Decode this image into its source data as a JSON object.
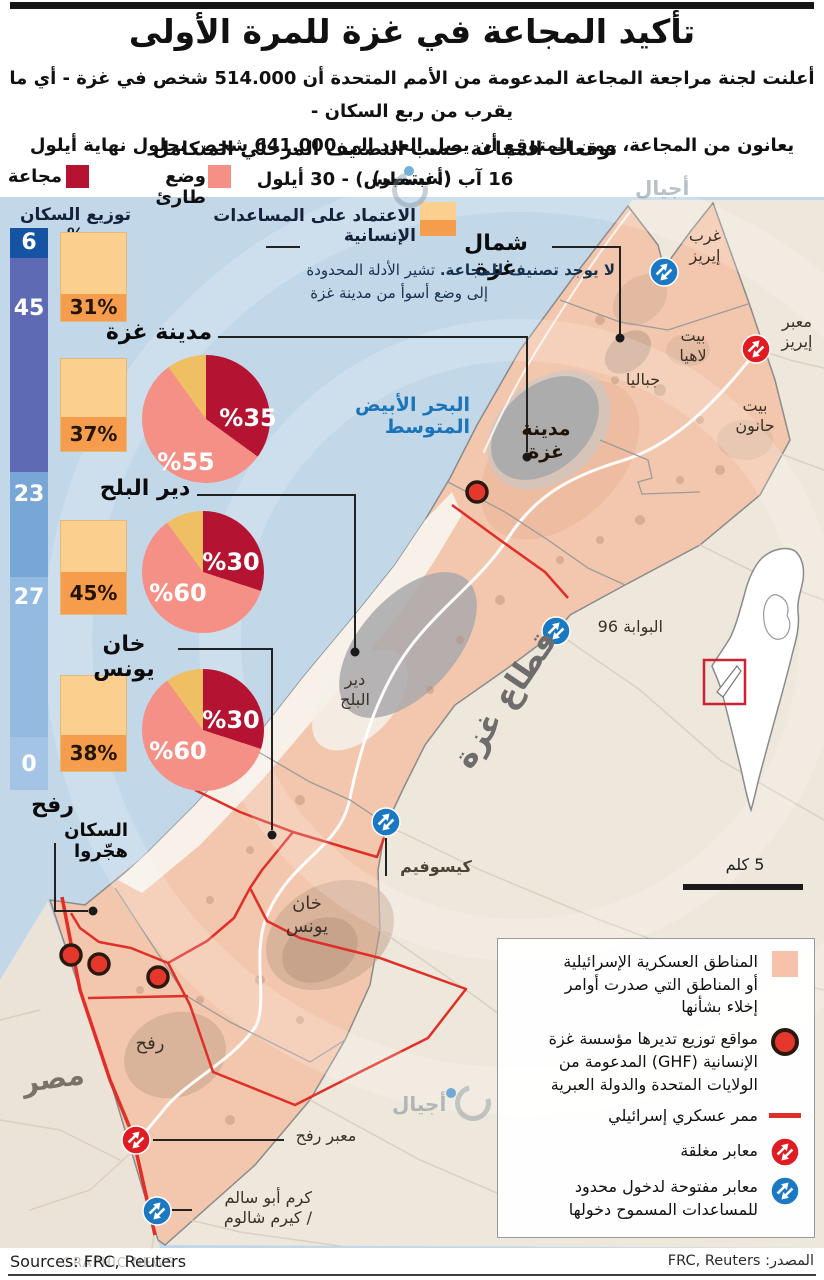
{
  "header": {
    "title": "تأكيد المجاعة في غزة للمرة الأولى",
    "intro_line1": "أعلنت لجنة مراجعة المجاعة المدعومة من الأمم المتحدة أن 514.000 شخص في غزة - أي ما يقرب من ربع السكان -",
    "intro_line2": "يعانون من المجاعة، ومن المتوقع أن يصل العدد إلى 641.000 شخص بحلول نهاية أيلول (سبتمبر)",
    "subtitle": "توقعات المجاعة حسب التصنيف المرحلي المتكامل",
    "date_range": "16 آب (أغسطس) - 30 أيلول"
  },
  "ipc_legend": {
    "famine_label": "مجاعة",
    "emergency_label": "وضع طارئ"
  },
  "panel": {
    "population_header": "توزيع السكان %",
    "aid_header": "الاعتماد على المساعدات الإنسانية"
  },
  "population_bar": [
    "6",
    "45",
    "23",
    "27",
    "0"
  ],
  "regions": [
    {
      "name": "شمال غزة",
      "aid_label": "31%",
      "note_bold": "لا يوجد تصنيف للمجاعة.",
      "note_rest": " تشير الأدلة المحدودة",
      "note_line2": "إلى وضع أسوأ من مدينة غزة"
    },
    {
      "name": "مدينة غزة",
      "aid_label": "37%",
      "famine_label": "%35",
      "emergency_label": "%55"
    },
    {
      "name": "دير البلح",
      "aid_label": "45%",
      "famine_label": "%30",
      "emergency_label": "%60"
    },
    {
      "name": "خان يونس",
      "aid_label": "38%",
      "famine_label": "%30",
      "emergency_label": "%60"
    },
    {
      "name": "رفح",
      "displaced_note": "السكان هجّروا"
    }
  ],
  "chart_data": {
    "type": "pie",
    "title": "توقعات المجاعة حسب التصنيف المرحلي المتكامل، 16 آب - 30 أيلول",
    "legend": [
      "مجاعة",
      "وضع طارئ"
    ],
    "series": [
      {
        "region": "شمال غزة",
        "famine_pct": null,
        "emergency_pct": null,
        "aid_dependence_pct": 31,
        "population_share_pct": 6
      },
      {
        "region": "مدينة غزة",
        "famine_pct": 35,
        "emergency_pct": 55,
        "aid_dependence_pct": 37,
        "population_share_pct": 45
      },
      {
        "region": "دير البلح",
        "famine_pct": 30,
        "emergency_pct": 60,
        "aid_dependence_pct": 45,
        "population_share_pct": 23
      },
      {
        "region": "خان يونس",
        "famine_pct": 30,
        "emergency_pct": 60,
        "aid_dependence_pct": 38,
        "population_share_pct": 27
      },
      {
        "region": "رفح",
        "famine_pct": null,
        "emergency_pct": null,
        "aid_dependence_pct": null,
        "population_share_pct": 0
      }
    ]
  },
  "map": {
    "sea_label": "البحر الأبيض المتوسط",
    "strip_label": "قطاع غزة",
    "egypt_label": "مصر",
    "scale_label": "5 كلم",
    "labels": {
      "west_erez_1": "غرب",
      "west_erez_2": "إيريز",
      "erez_1": "معبر",
      "erez_2": "إيريز",
      "beit_lahia_1": "بيت",
      "beit_lahia_2": "لاهيا",
      "jabalia": "جباليا",
      "beit_hanoun_1": "بيت",
      "beit_hanoun_2": "حانون",
      "gaza_city_1": "مدينة",
      "gaza_city_2": "غزة",
      "deir_1": "دير",
      "deir_2": "البلح",
      "gate96": "البوابة 96",
      "kissufim": "كيسوفيم",
      "khan_1": "خان",
      "khan_2": "يونس",
      "rafah": "رفح",
      "rafah_crossing": "معبر رفح",
      "kerem_1": "كرم أبو سالم",
      "kerem_2": "/ كيرم شالوم"
    }
  },
  "legend_box": {
    "military_1": "المناطق العسكرية الإسرائيلية",
    "military_2": "أو المناطق التي صدرت أوامر",
    "military_3": "إخلاء بشأنها",
    "ghf_1": "مواقع توزيع تديرها مؤسسة غزة",
    "ghf_2": "الإنسانية (GHF) المدعومة من",
    "ghf_3": "الولايات المتحدة والدولة العبرية",
    "corridor": "ممر عسكري إسرائيلي",
    "closed": "معابر مغلقة",
    "open_1": "معابر مفتوحة لدخول محدود",
    "open_2": "للمساعدات المسموح دخولها"
  },
  "footer": {
    "sources_en": "Sources: FRC, Reuters",
    "sources_ar": "المصدر: FRC, Reuters",
    "ghost": "GRAPHIC NEWS",
    "watermark": "أجيال"
  },
  "colors": {
    "famine": "#b51332",
    "emergency": "#f59086",
    "other_slice": "#efc063",
    "aid_light": "#fbcf8e",
    "aid_dark": "#f59d4d",
    "closed_crossing": "#e01b22",
    "open_crossing": "#1a79c2",
    "ghf_dot": "#e5372b",
    "corridor": "#e02f28"
  }
}
